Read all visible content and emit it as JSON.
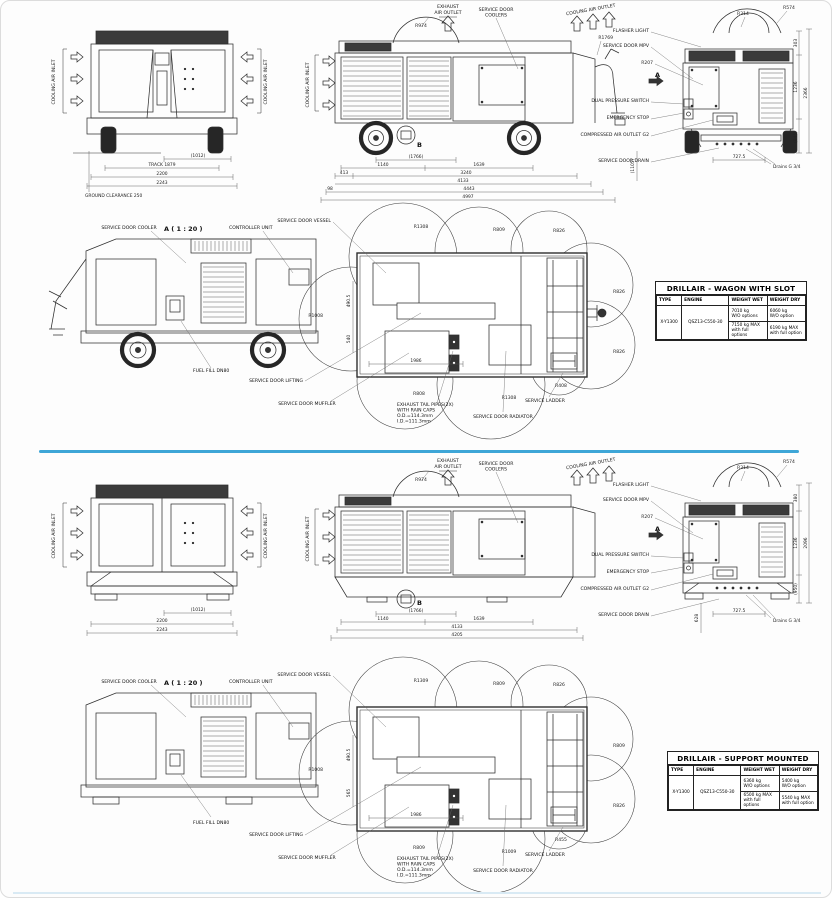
{
  "divider_color": "#3ea6d7",
  "wagon": {
    "front": {
      "inlet_left": "COOLING AIR INLET",
      "inlet_right": "COOLING AIR INLET",
      "dim_hub": "(1012)",
      "dim_track": "TRACK 1879",
      "dim_body": "2200",
      "dim_overall": "2243",
      "ground": "GROUND CLEARANCE 250"
    },
    "side": {
      "exhaust_1": "EXHAUST",
      "exhaust_2": "AIR OUTLET",
      "coolers_1": "SERVICE DOOR",
      "coolers_2": "COOLERS",
      "outlet": "COOLING AIR OUTLET",
      "inlet": "COOLING AIR INLET",
      "r_dome": "R974",
      "r_towbar": "R1769",
      "marker_b": "B",
      "dim_axle": "(1766)",
      "dim_1140": "1140",
      "dim_1639": "1639",
      "dim_413": "413",
      "dim_3240": "3240",
      "dim_4133": "4133",
      "dim_98": "98",
      "dim_4443": "4443",
      "dim_overall": "4997"
    },
    "rear": {
      "flasher": "FLASHER LIGHT",
      "mpv": "SERVICE DOOR MPV",
      "r207": "R207",
      "dps": "DUAL PRESSURE SWITCH",
      "estop": "EMERGENCY STOP",
      "outlet": "COMPRESSED AIR OUTLET G2",
      "drain": "SERVICE DOOR DRAIN",
      "r314": "R314",
      "r574": "R574",
      "marker_a": "A",
      "dim_top": "303",
      "dim_mid": "1236",
      "dim_low": "(945)",
      "dim_overall": "2366",
      "dim_left": "(1105)",
      "dim_track": "727.5",
      "drains": "Drains G 3/4"
    },
    "detail": {
      "cooler": "SERVICE DOOR COOLER",
      "scale": "A ( 1 : 20 )",
      "controller": "CONTROLLER UNIT",
      "fuel": "FUEL FILL DN80"
    },
    "plan": {
      "vessel": "SERVICE DOOR VESSEL",
      "lifting": "SERVICE DOOR LIFTING",
      "muffler": "SERVICE DOOR MUFFLER",
      "note_1": "EXHAUST TAIL PIPES(2X)",
      "note_2": "WITH RAIN CAPS",
      "note_3": "O.D.=114.3mm",
      "note_4": "I.D.=111.3mm",
      "radiator": "SERVICE DOOR RADIATOR",
      "ladder": "SERVICE LADDER",
      "r_tl": "R1308",
      "r_tm": "R809",
      "r_tr": "R826",
      "r_rt": "R826",
      "r_rb": "R826",
      "r_lf": "R1008",
      "r_bl": "R808",
      "r_bm": "R1308",
      "r_br": "R408",
      "dim_w": "1986",
      "dim_h1": "490.5",
      "dim_h2": "540"
    },
    "table": {
      "title": "DRILLAIR - WAGON WITH SLOT",
      "h_type": "TYPE",
      "h_engine": "ENGINE",
      "h_wet": "WEIGHT WET",
      "h_dry": "WEIGHT DRY",
      "type": "X-Y1300",
      "engine": "QSZ13-C550-30",
      "wet_a1": "7010 kg",
      "wet_a2": "W/O options",
      "wet_b1": "7150 kg MAX",
      "wet_b2": "with full options",
      "dry_a1": "6060 kg",
      "dry_a2": "W/O option",
      "dry_b1": "6190 kg MAX",
      "dry_b2": "with full option"
    }
  },
  "support": {
    "front": {
      "inlet_left": "COOLING AIR INLET",
      "inlet_right": "COOLING AIR INLET",
      "dim_hub": "(1012)",
      "dim_body": "2200",
      "dim_overall": "2243"
    },
    "side": {
      "exhaust_1": "EXHAUST",
      "exhaust_2": "AIR OUTLET",
      "coolers_1": "SERVICE DOOR",
      "coolers_2": "COOLERS",
      "outlet": "COOLING AIR OUTLET",
      "inlet": "COOLING AIR INLET",
      "r_dome": "R974",
      "marker_b": "B",
      "dim_axle": "(1766)",
      "dim_1140": "1140",
      "dim_1639": "1639",
      "dim_4133": "4133",
      "dim_overall": "4205"
    },
    "rear": {
      "flasher": "FLASHER LIGHT",
      "mpv": "SERVICE DOOR MPV",
      "r207": "R207",
      "dps": "DUAL PRESSURE SWITCH",
      "estop": "EMERGENCY STOP",
      "outlet": "COMPRESSED AIR OUTLET G2",
      "drain": "SERVICE DOOR DRAIN",
      "r314": "R314",
      "r574": "R574",
      "marker_a": "A",
      "dim_top": "380",
      "dim_mid": "1236",
      "dim_low": "(950)",
      "dim_overall": "2096",
      "dim_left": "628",
      "dim_track": "727.5",
      "drains": "Drains G 3/4"
    },
    "detail": {
      "cooler": "SERVICE DOOR COOLER",
      "scale": "A ( 1 : 20 )",
      "controller": "CONTROLLER UNIT",
      "fuel": "FUEL FILL DN80"
    },
    "plan": {
      "vessel": "SERVICE DOOR VESSEL",
      "lifting": "SERVICE DOOR LIFTING",
      "muffler": "SERVICE DOOR MUFFLER",
      "note_1": "EXHAUST TAIL PIPES(2X)",
      "note_2": "WITH RAIN CAPS",
      "note_3": "O.D.=114.3mm",
      "note_4": "I.D.=111.3mm",
      "radiator": "SERVICE DOOR RADIATOR",
      "ladder": "SERVICE LADDER",
      "r_tl": "R1309",
      "r_tm": "R809",
      "r_tr": "R826",
      "r_rt": "R809",
      "r_rb": "R826",
      "r_lf": "R1008",
      "r_bl": "R809",
      "r_bm": "R1009",
      "r_br": "R455",
      "dim_w": "1986",
      "dim_h1": "490.5",
      "dim_h2": "565"
    },
    "table": {
      "title": "DRILLAIR - SUPPORT MOUNTED",
      "h_type": "TYPE",
      "h_engine": "ENGINE",
      "h_wet": "WEIGHT WET",
      "h_dry": "WEIGHT DRY",
      "type": "X-Y1300",
      "engine": "QSZ13-C550-30",
      "wet_a1": "6360 kg",
      "wet_a2": "W/O options",
      "wet_b1": "6500 kg MAX",
      "wet_b2": "with full options",
      "dry_a1": "5400 kg",
      "dry_a2": "W/O option",
      "dry_b1": "5540 kg MAX",
      "dry_b2": "with full option"
    }
  }
}
